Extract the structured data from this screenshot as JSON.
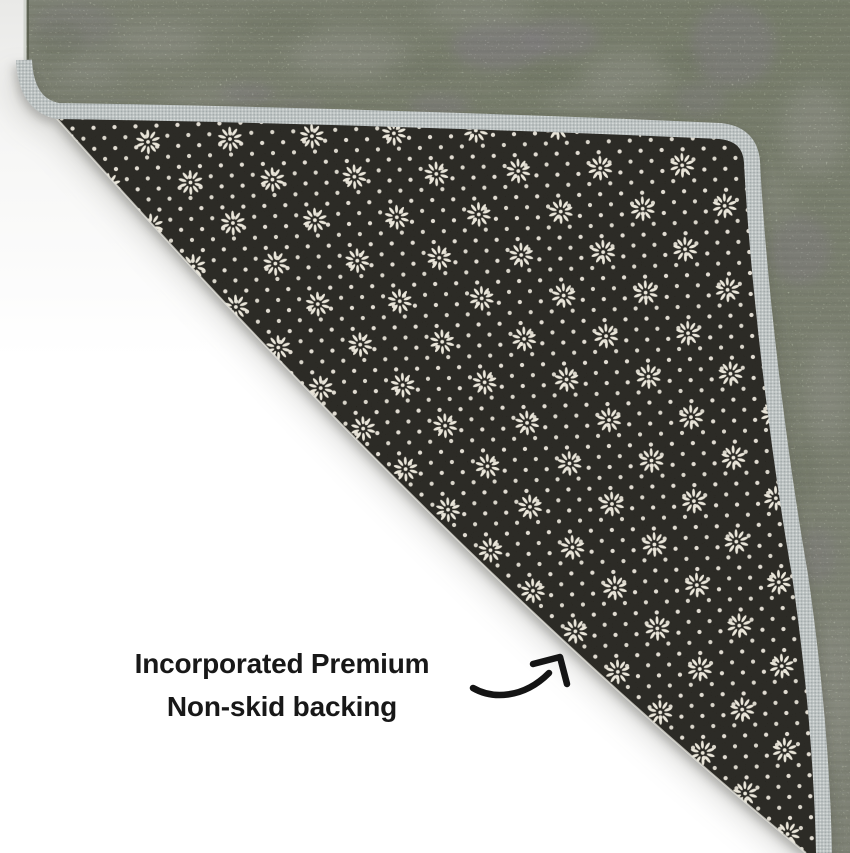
{
  "caption": {
    "line1": "Incorporated Premium",
    "line2": "Non-skid backing"
  },
  "annotation": {
    "arrow_direction": "up-right"
  },
  "scene": {
    "subject": "rug corner folded over to show non-skid backing",
    "regions": [
      "rug-pile-surface",
      "gray-edge-binding",
      "black-dotted-non-skid-backing",
      "white-floor"
    ]
  },
  "colors": {
    "background": "#ffffff",
    "pile_green": "#7e9060",
    "pile_sage": "#c6ccb8",
    "pile_purple": "#9a8fa3",
    "binding_gray": "#b5bcbc",
    "backing_dark": "#15130e",
    "backing_dots": "#ded9cd",
    "caption_text": "#181818",
    "arrow": "#141414"
  }
}
